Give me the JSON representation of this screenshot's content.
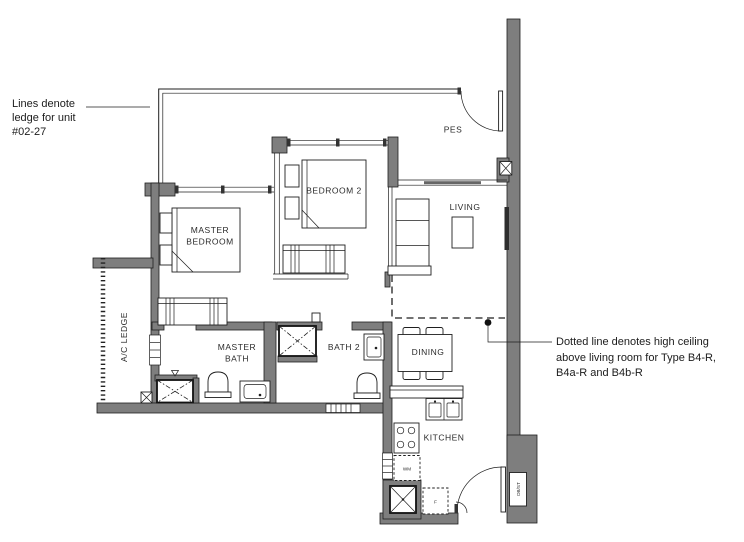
{
  "annotations": {
    "ledge_note": {
      "line1": "Lines denote",
      "line2": "ledge for unit",
      "line3": "#02-27"
    },
    "ceiling_note": {
      "line1": "Dotted line denotes high ceiling",
      "line2": "above living room for Type B4-R,",
      "line3": "B4a-R and B4b-R"
    }
  },
  "rooms": {
    "pes": "PES",
    "living": "LIVING",
    "bedroom2": "BEDROOM 2",
    "master_bedroom_line1": "MASTER",
    "master_bedroom_line2": "BEDROOM",
    "master_bath_line1": "MASTER",
    "master_bath_line2": "BATH",
    "bath2": "BATH 2",
    "dining": "DINING",
    "kitchen": "KITCHEN",
    "ac_ledge": "A/C LEDGE"
  },
  "labels": {
    "washing_machine": "WM",
    "fridge": "F",
    "db_st": "DB/ST"
  },
  "colors": {
    "wall": "#7e7e7e",
    "line": "#1f1f1f",
    "background": "#ffffff"
  }
}
